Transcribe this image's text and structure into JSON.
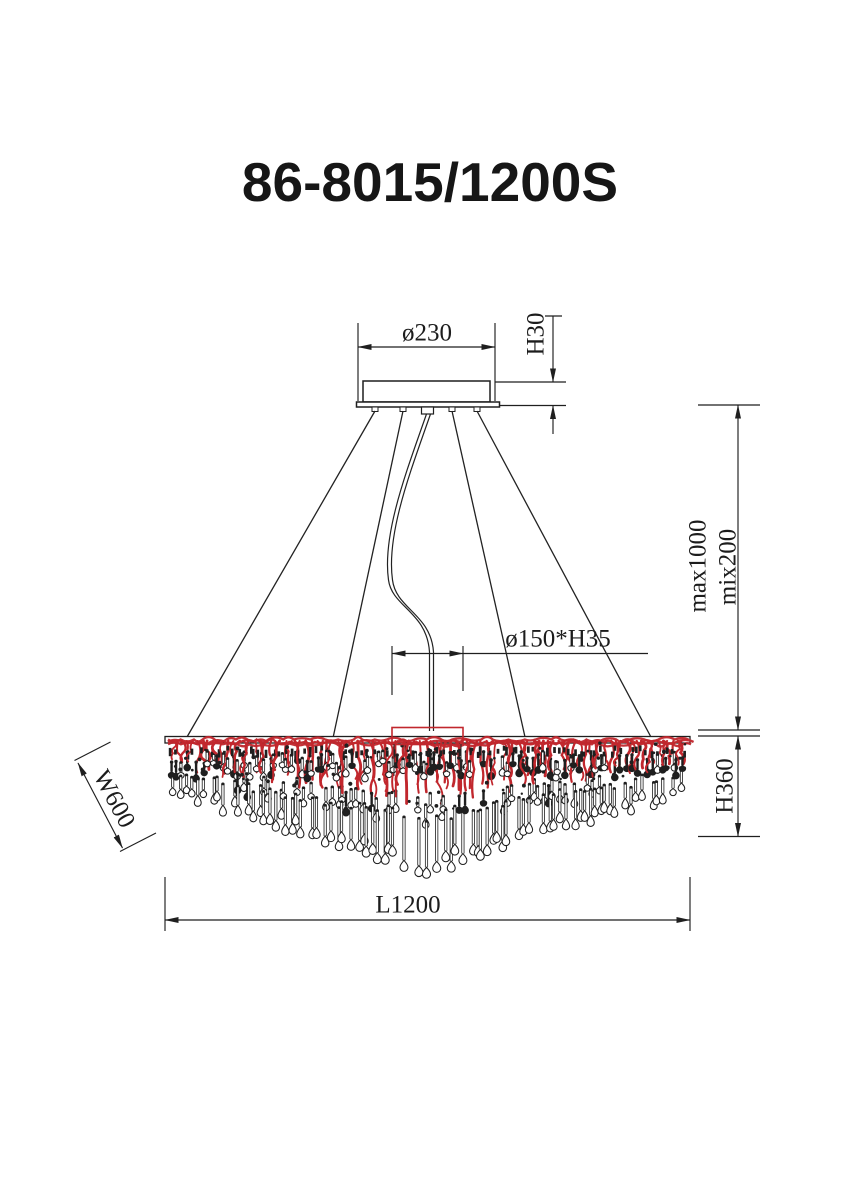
{
  "title": {
    "text": "86-8015/1200S"
  },
  "dimensions": {
    "canopy_diameter": {
      "label": "ø230"
    },
    "canopy_height": {
      "label": "H30"
    },
    "suspension_max": {
      "label": "max1000"
    },
    "suspension_min": {
      "label": "mix200"
    },
    "center_plate": {
      "label": "ø150*H35"
    },
    "body_width": {
      "label": "W600"
    },
    "body_height": {
      "label": "H360"
    },
    "body_length": {
      "label": "L1200"
    }
  },
  "drawing": {
    "ink": "#1f1f1f",
    "red": "#c1272d",
    "paper": "#ffffff",
    "fringe": {
      "x1": 168,
      "x2": 687,
      "yTop": 737,
      "centerX": 427,
      "endDepth": 52,
      "peakDepth": 130,
      "strands": 100,
      "seed": 11
    }
  }
}
